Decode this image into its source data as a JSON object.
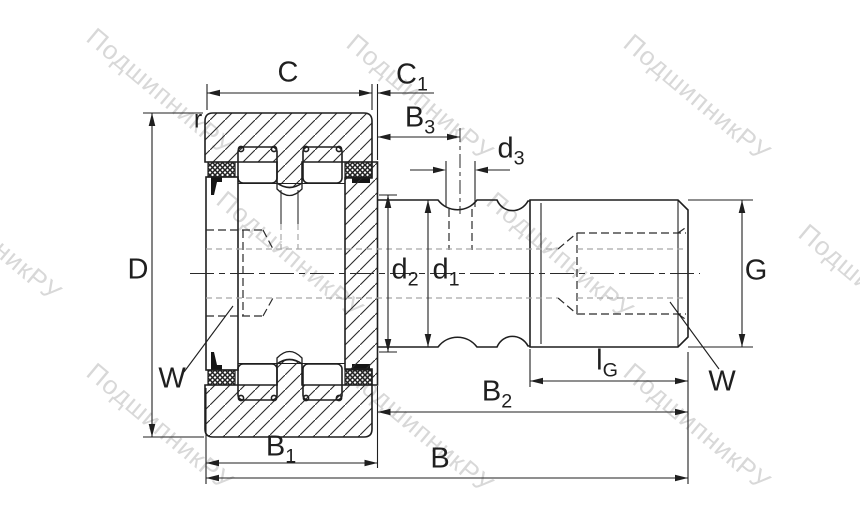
{
  "drawing": {
    "kind": "bearing cross-section dimension drawing",
    "dimension_labels": [
      "C",
      "C1",
      "B3",
      "d3",
      "r",
      "D",
      "d2",
      "d1",
      "G",
      "W",
      "lG",
      "W",
      "B2",
      "B1",
      "B"
    ]
  },
  "labels": {
    "C": {
      "main": "C",
      "sub": ""
    },
    "C1": {
      "main": "C",
      "sub": "1"
    },
    "B3": {
      "main": "B",
      "sub": "3"
    },
    "d3": {
      "main": "d",
      "sub": "3"
    },
    "r": {
      "main": "r",
      "sub": ""
    },
    "D": {
      "main": "D",
      "sub": ""
    },
    "d2": {
      "main": "d",
      "sub": "2"
    },
    "d1": {
      "main": "d",
      "sub": "1"
    },
    "G": {
      "main": "G",
      "sub": ""
    },
    "W_left": {
      "main": "W",
      "sub": ""
    },
    "lG": {
      "main": "l",
      "sub": "G"
    },
    "W_right": {
      "main": "W",
      "sub": ""
    },
    "B2": {
      "main": "B",
      "sub": "2"
    },
    "B1": {
      "main": "B",
      "sub": "1"
    },
    "B": {
      "main": "B",
      "sub": ""
    }
  },
  "watermark": {
    "text": "ПодшипникРУ",
    "color": "#d8d8d8"
  },
  "colors": {
    "line": "#1f1f1f",
    "hatch": "#2b2b2b",
    "hidden_dark": "#2a2a2a",
    "hidden_gray": "#a8a8a8",
    "background": "#ffffff"
  }
}
